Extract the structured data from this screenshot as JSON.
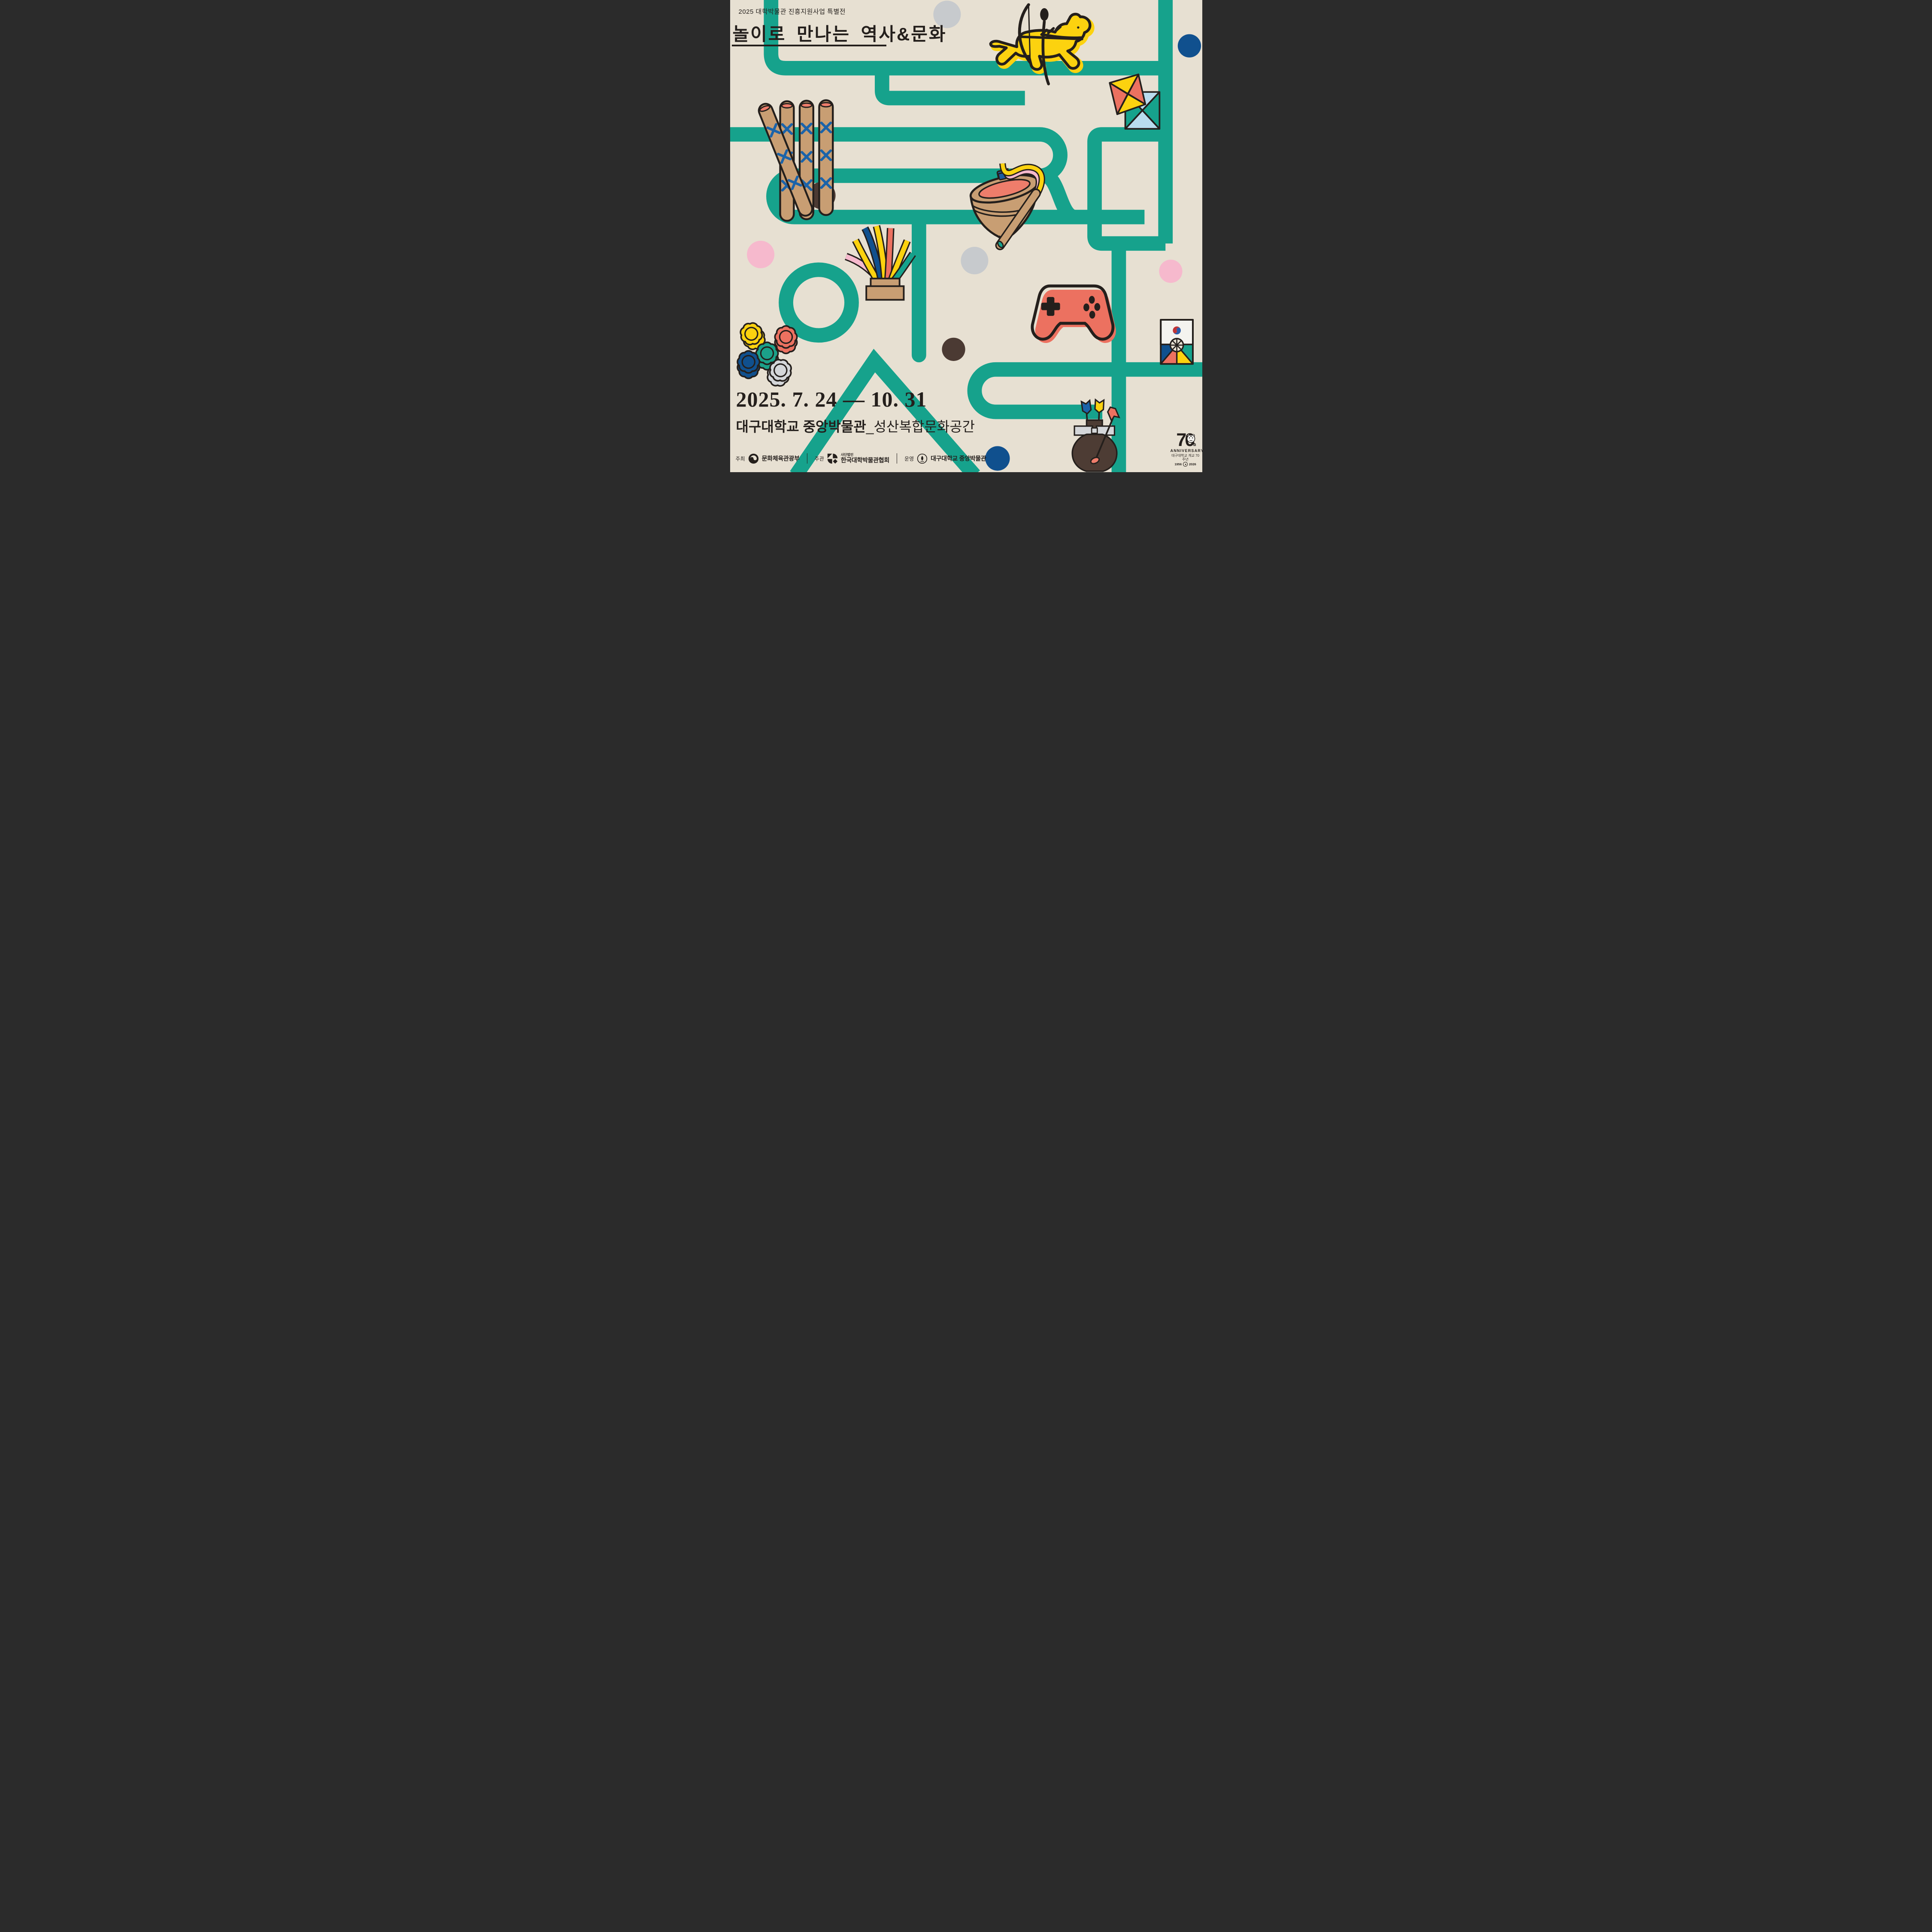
{
  "poster": {
    "top_label": "2025 대학박물관 진흥지원사업 특별전",
    "title": "놀이로 만나는 역사&문화",
    "date_range": "2025. 7. 24 — 10. 31",
    "venue_bold": "대구대학교 중앙박물관",
    "venue_light": "_성산복합문화공간",
    "footer": {
      "host_label": "주최",
      "host_name": "문화체육관광부",
      "org_label": "주관",
      "org_small": "사단법인",
      "org_name": "한국대학박물관협회",
      "op_label": "운영",
      "op_name": "대구대학교 중앙박물관"
    },
    "anniversary": {
      "big": "70",
      "suffix": "th",
      "word": "ANNIVERSARY",
      "line": "대구대학교 개교 70주년",
      "years_from": "1956",
      "years_to": "2026"
    },
    "colors": {
      "background": "#e7e0d2",
      "maze_teal": "#16a28c",
      "ink_black": "#241f1c",
      "yellow": "#fcd20f",
      "coral": "#ec7160",
      "pink": "#f6b9cd",
      "navy": "#10508e",
      "flag_blue": "#1b63a9",
      "tan": "#c89e73",
      "dark_brown": "#4d3c34",
      "gray": "#c7cacd",
      "silver": "#d4d6d9",
      "light_blue": "#b9dcee",
      "white": "#f4f3ef",
      "taegeuk_red": "#c03335",
      "taegeuk_blue": "#2a5daa"
    },
    "illustrations": [
      "mounted-archer",
      "kites",
      "yut-sticks",
      "spinning-top-and-whip",
      "jegi-shuttlecock",
      "game-controller",
      "flower-game-pieces",
      "ttakji-flag-card",
      "tuho-arrow-pot"
    ]
  }
}
